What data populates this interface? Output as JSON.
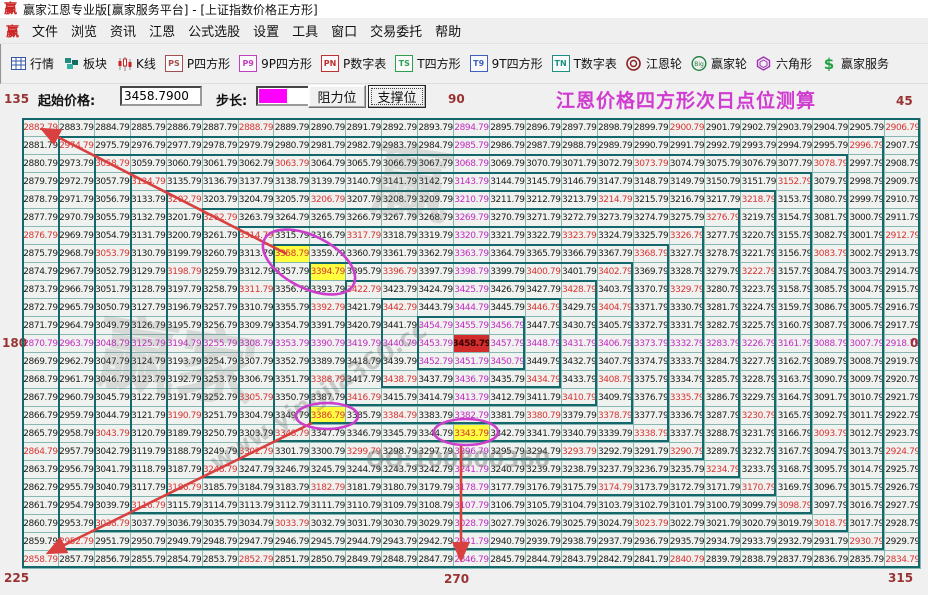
{
  "window": {
    "logo_text": "赢",
    "title": "赢家江恩专业版[赢家服务平台] - [上证指数价格正方形]"
  },
  "menu": {
    "items": [
      "文件",
      "浏览",
      "资讯",
      "江恩",
      "公式选股",
      "设置",
      "工具",
      "窗口",
      "交易委托",
      "帮助"
    ]
  },
  "toolbar": {
    "items": [
      {
        "id": "quotes",
        "label": "行情",
        "icon": "table",
        "color": "#3355AA"
      },
      {
        "id": "sectors",
        "label": "板块",
        "icon": "blocks",
        "color": "#1E8A80"
      },
      {
        "id": "kline",
        "label": "K线",
        "icon": "candles",
        "color": "#CC2222"
      },
      {
        "id": "p-square",
        "label": "P四方形",
        "icon": "badge",
        "badge": "PS",
        "color": "#A05050"
      },
      {
        "id": "9p-square",
        "label": "9P四方形",
        "icon": "badge",
        "badge": "P9",
        "color": "#C040C0"
      },
      {
        "id": "p-table",
        "label": "P数字表",
        "icon": "badge",
        "badge": "PN",
        "color": "#C03030"
      },
      {
        "id": "t-square",
        "label": "T四方形",
        "icon": "badge",
        "badge": "TS",
        "color": "#2E9E50"
      },
      {
        "id": "9t-square",
        "label": "9T四方形",
        "icon": "badge",
        "badge": "T9",
        "color": "#4060C0"
      },
      {
        "id": "t-table",
        "label": "T数字表",
        "icon": "badge",
        "badge": "TN",
        "color": "#1E9080"
      },
      {
        "id": "gann-wheel",
        "label": "江恩轮",
        "icon": "wheel",
        "color": "#8B2020"
      },
      {
        "id": "winner-wheel",
        "label": "赢家轮",
        "icon": "bigwheel",
        "color": "#208040",
        "badge": "Big"
      },
      {
        "id": "hexagon",
        "label": "六角形",
        "icon": "hexagon",
        "color": "#A030B0"
      },
      {
        "id": "service",
        "label": "赢家服务",
        "icon": "dollar",
        "color": "#22A044"
      }
    ]
  },
  "controls": {
    "start_price_label": "起始价格:",
    "start_price_value": "3458.7900",
    "step_label": "步长:",
    "step_color": "#FF00FF",
    "resistance_label": "阻力位",
    "support_label": "支撑位",
    "heading": "江恩价格四方形次日点位测算",
    "heading_color": "#D03BD0"
  },
  "angles": {
    "top_left": "135",
    "top_center": "90",
    "top_right": "45",
    "left": "180",
    "right": "0",
    "bottom_left": "225",
    "bottom_center": "270",
    "bottom_right": "315"
  },
  "grid": {
    "rows": 25,
    "cols": 25,
    "start_price": 3458.79,
    "step": 1.0,
    "spiral": "square spiral, counterclockwise starting East, values decrease outward from center",
    "center_value": 3458.79,
    "min_value": 2834.79,
    "corner_values": {
      "top_left": 2882.79,
      "top_right": 2906.79,
      "bottom_left": 2858.79,
      "bottom_right": 2834.79
    },
    "axis_end_values": {
      "up_90": 2894.79,
      "left_180": 2870.79,
      "right_0": 2918.79,
      "down_270": 2846.79
    },
    "yellow_cells": [
      {
        "dx": -5,
        "dy": 5,
        "value": 3358.79
      },
      {
        "dx": -4,
        "dy": 4,
        "value": 3394.79
      },
      {
        "dx": -4,
        "dy": -4,
        "value": 3386.79
      },
      {
        "dx": 0,
        "dy": -5,
        "value": 3343.79
      }
    ],
    "colors": {
      "default_text": "#1C1C1C",
      "axis_text": "#C32BC3",
      "ray_text": "#D93434",
      "yellow_bg": "#FFFF3D",
      "center_bg": "#D22C2C",
      "grid_line": "#86B7B3",
      "ring_border": "#14686B",
      "cell_bg": "#EFF2EE"
    }
  },
  "annotations": {
    "ellipse_color": "#CC3FCC",
    "arrow_color": "#D94040",
    "ellipses": [
      {
        "cx": 309,
        "cy": 262,
        "rx": 50,
        "ry": 26,
        "rot": 27,
        "around_values": [
          3358.79,
          3394.79
        ]
      },
      {
        "cx": 327,
        "cy": 416,
        "rx": 31,
        "ry": 13,
        "rot": 0,
        "around_values": [
          3386.79
        ]
      },
      {
        "cx": 466,
        "cy": 432,
        "rx": 32,
        "ry": 13,
        "rot": 0,
        "around_values": [
          3343.79
        ]
      }
    ],
    "arrows": [
      {
        "x1": 287,
        "y1": 254,
        "x2": 42,
        "y2": 129,
        "direction": "135-degree diagonal to top-left corner"
      },
      {
        "x1": 312,
        "y1": 423,
        "x2": 48,
        "y2": 553,
        "direction": "225-degree diagonal to bottom-left corner"
      },
      {
        "x1": 461,
        "y1": 445,
        "x2": 461,
        "y2": 560,
        "direction": "270-degree vertical to bottom edge"
      }
    ]
  },
  "watermarks": [
    {
      "text": "赢",
      "x": 372,
      "y": 120,
      "size": 80,
      "rot": 8,
      "opacity": 0.18
    },
    {
      "text": "赢家",
      "x": 98,
      "y": 298,
      "size": 80,
      "rot": 8,
      "opacity": 0.18
    },
    {
      "text": "www.yingjia360.cc",
      "x": 192,
      "y": 382,
      "size": 24,
      "rot": -33,
      "opacity": 0.3
    },
    {
      "text": "QQ:100800360",
      "x": 366,
      "y": 448,
      "size": 22,
      "rot": 0,
      "opacity": 0.4
    }
  ]
}
